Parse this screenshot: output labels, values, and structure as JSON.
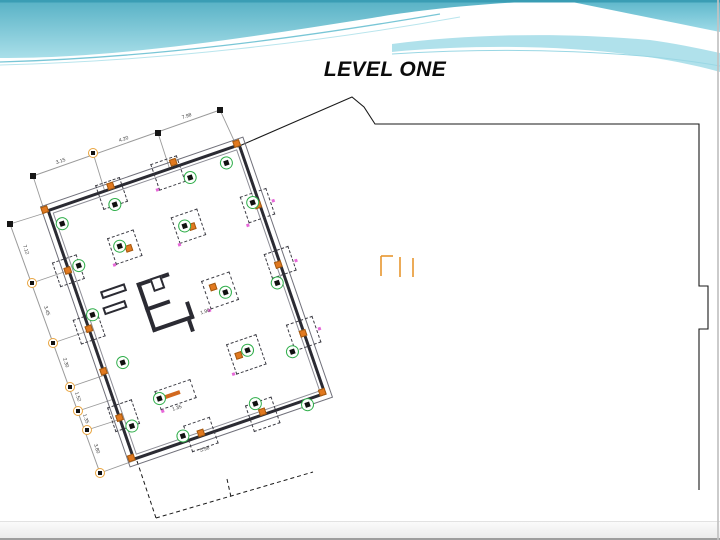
{
  "slide": {
    "title": "LEVEL ONE"
  },
  "colors": {
    "teal_dark": "#3a9db4",
    "teal_main": "#57b1c5",
    "teal_light": "#a9dfe9",
    "teal_corner_top": "#5cb6ca",
    "teal_corner_bottom": "#9fdbe8",
    "teal_band": "#a7dee9",
    "stripe1": "#79c6d6",
    "stripe2": "#a8dfe9",
    "stripe3": "#9ad7e4",
    "wall": "#2b2b33",
    "green": "#2fae4a",
    "orange": "#e2791f",
    "orange_ring": "#e8a33d",
    "pink": "#e668d8",
    "dim_line": "#9a9a9a",
    "outline": "#1a1a1a",
    "glyph": "#e8962e"
  },
  "plan": {
    "box": {
      "left": 85,
      "top": 170,
      "width": 203,
      "height": 264,
      "rotation_deg": -19
    },
    "green_markers": [
      [
        9,
        17
      ],
      [
        65,
        16
      ],
      [
        145,
        15
      ],
      [
        184,
        13
      ],
      [
        196,
        59
      ],
      [
        193,
        143
      ],
      [
        185,
        213
      ],
      [
        11,
        62
      ],
      [
        8,
        113
      ],
      [
        21,
        168
      ],
      [
        9,
        231
      ],
      [
        54,
        257
      ],
      [
        133,
        250
      ],
      [
        182,
        268
      ],
      [
        56,
        57
      ],
      [
        124,
        59
      ],
      [
        141,
        135
      ],
      [
        143,
        197
      ],
      [
        44,
        214
      ]
    ],
    "orange_markers": [
      [
        -3,
        -2
      ],
      [
        200,
        -2
      ],
      [
        -2,
        261
      ],
      [
        200,
        261
      ],
      [
        67,
        -3
      ],
      [
        134,
        -5
      ],
      [
        200,
        63
      ],
      [
        200,
        126
      ],
      [
        201,
        199
      ],
      [
        -1,
        63
      ],
      [
        0,
        125
      ],
      [
        0,
        170
      ],
      [
        0,
        219
      ],
      [
        72,
        260
      ],
      [
        137,
        260
      ],
      [
        64,
        62
      ],
      [
        131,
        62
      ],
      [
        131,
        126
      ],
      [
        133,
        199
      ]
    ],
    "footings": [
      [
        47,
        46,
        28
      ],
      [
        114,
        47,
        28
      ],
      [
        122,
        117,
        30
      ],
      [
        125,
        185,
        32
      ],
      [
        112,
        -10,
        28
      ],
      [
        186,
        50,
        28
      ],
      [
        188,
        186,
        28
      ],
      [
        -13,
        51,
        26
      ],
      [
        -8,
        206,
        26
      ],
      [
        58,
        248,
        28
      ],
      [
        123,
        249,
        28
      ],
      [
        190,
        112,
        26
      ],
      [
        -12,
        112,
        26
      ],
      [
        53,
        -8,
        26
      ]
    ],
    "pink_marks": [
      [
        45,
        73
      ],
      [
        113,
        75
      ],
      [
        120,
        147
      ],
      [
        122,
        215
      ],
      [
        184,
        79
      ],
      [
        216,
        64
      ],
      [
        218,
        128
      ],
      [
        218,
        200
      ],
      [
        110,
        16
      ],
      [
        43,
        227
      ]
    ],
    "core_walls": [
      [
        60,
        98,
        4,
        52
      ],
      [
        60,
        98,
        34,
        4
      ],
      [
        60,
        124,
        26,
        4
      ],
      [
        60,
        146,
        44,
        4
      ],
      [
        100,
        132,
        4,
        18
      ],
      [
        96,
        150,
        4,
        12
      ]
    ],
    "core_box": [
      74,
      98,
      12,
      14
    ],
    "loose_walls": [
      [
        23,
        94,
        26,
        8
      ],
      [
        20,
        110,
        24,
        8
      ]
    ],
    "small_footing": {
      "x": 42,
      "y": 206,
      "w": 38,
      "h": 20,
      "bar": [
        50,
        213,
        16,
        4
      ]
    },
    "inner_labels": [
      {
        "t": "1.35",
        "x": 58,
        "y": 230
      },
      {
        "t": "1.90",
        "x": 116,
        "y": 148
      }
    ]
  },
  "dimensions": {
    "chains": [
      [
        220,
        110,
        33,
        176
      ],
      [
        10,
        224,
        100,
        473
      ]
    ],
    "plain_markers": [
      [
        220,
        110
      ],
      [
        158,
        133
      ],
      [
        33,
        176
      ],
      [
        10,
        224
      ]
    ],
    "ring_markers": [
      [
        93,
        153
      ],
      [
        32,
        283
      ],
      [
        53,
        343
      ],
      [
        70,
        387
      ],
      [
        78,
        411
      ],
      [
        87,
        430
      ],
      [
        100,
        473
      ]
    ],
    "extensions": [
      [
        237,
        147,
        220,
        110
      ],
      [
        170,
        170,
        158,
        133
      ],
      [
        105,
        192,
        93,
        153
      ],
      [
        45,
        213,
        33,
        176
      ],
      [
        45,
        213,
        10,
        224
      ],
      [
        67,
        271,
        32,
        283
      ],
      [
        88,
        331,
        53,
        343
      ],
      [
        105,
        375,
        70,
        387
      ],
      [
        114,
        399,
        78,
        411
      ],
      [
        121,
        419,
        87,
        430
      ],
      [
        136,
        460,
        100,
        473
      ]
    ],
    "labels": [
      {
        "t": "7.98",
        "x": 187,
        "y": 117,
        "r": -19
      },
      {
        "t": "4.20",
        "x": 124,
        "y": 140,
        "r": -19
      },
      {
        "t": "3.15",
        "x": 61,
        "y": 162,
        "r": -19
      },
      {
        "t": "7.12",
        "x": 25,
        "y": 250,
        "r": 71
      },
      {
        "t": "3.45",
        "x": 46,
        "y": 311,
        "r": 71
      },
      {
        "t": "2.30",
        "x": 65,
        "y": 363,
        "r": 71
      },
      {
        "t": "1.52",
        "x": 77,
        "y": 397,
        "r": 71
      },
      {
        "t": "1.35",
        "x": 85,
        "y": 419,
        "r": 71
      },
      {
        "t": "3.80",
        "x": 96,
        "y": 449,
        "r": 71
      },
      {
        "t": "5.98",
        "x": 205,
        "y": 450,
        "r": -19
      }
    ]
  },
  "site_outline": {
    "solid_points": [
      [
        237,
        147
      ],
      [
        352,
        97
      ],
      [
        364,
        107
      ],
      [
        375,
        124
      ],
      [
        699,
        124
      ],
      [
        699,
        286
      ],
      [
        708,
        286
      ],
      [
        708,
        329
      ],
      [
        699,
        329
      ],
      [
        699,
        490
      ]
    ],
    "dashed_segments": [
      [
        137,
        461,
        156,
        518
      ],
      [
        156,
        518,
        313,
        472
      ],
      [
        227,
        479,
        231,
        497
      ]
    ]
  },
  "glyph": {
    "segments": [
      [
        381,
        256,
        381,
        276
      ],
      [
        381,
        256,
        393,
        256
      ],
      [
        400,
        257,
        400,
        277
      ],
      [
        413,
        258,
        413,
        277
      ]
    ]
  }
}
